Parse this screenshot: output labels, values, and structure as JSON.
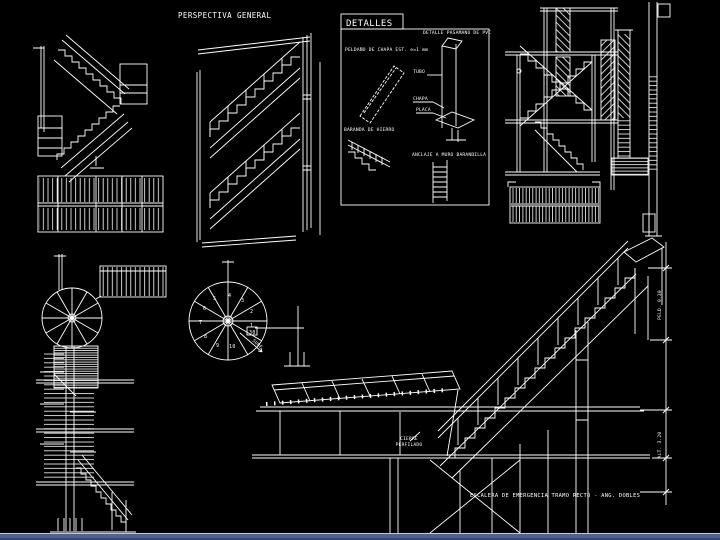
{
  "app": {
    "background": "#000000",
    "line_color": "#ffffff",
    "statusbar": {
      "highlight": "#c3c8e2",
      "bar": "#4d6492",
      "shadow": "#37486e"
    }
  },
  "titles": {
    "perspective": "PERSPECTIVA GENERAL",
    "details": "DETALLES"
  },
  "details_labels": {
    "step_plate": "PELDAÑO DE CHAPA EST. e=1 mm",
    "handrail": "DETALLE PASAMANO DE PVC",
    "post": "TUBO",
    "chapa": "CHAPA",
    "placa": "PLACA",
    "iron_rail": "BARANDA DE HIERRO",
    "wall_anchor": "ANCLAJE A MURO BARANDILLA"
  },
  "annotations": {
    "closure_1": "CIERRE",
    "closure_2": "PERFILADO",
    "banner": "ESCALERA DE EMERGENCIA TRAMO RECTO - ANG. DOBLES",
    "dim_upper": "PELD. 0.30",
    "dim_lower": "ALT. 3.20",
    "tread_width": "30",
    "up_label": "SUBE"
  },
  "spiral_numbers": [
    "1",
    "2",
    "3",
    "4",
    "5",
    "6",
    "7",
    "8",
    "9",
    "10"
  ]
}
